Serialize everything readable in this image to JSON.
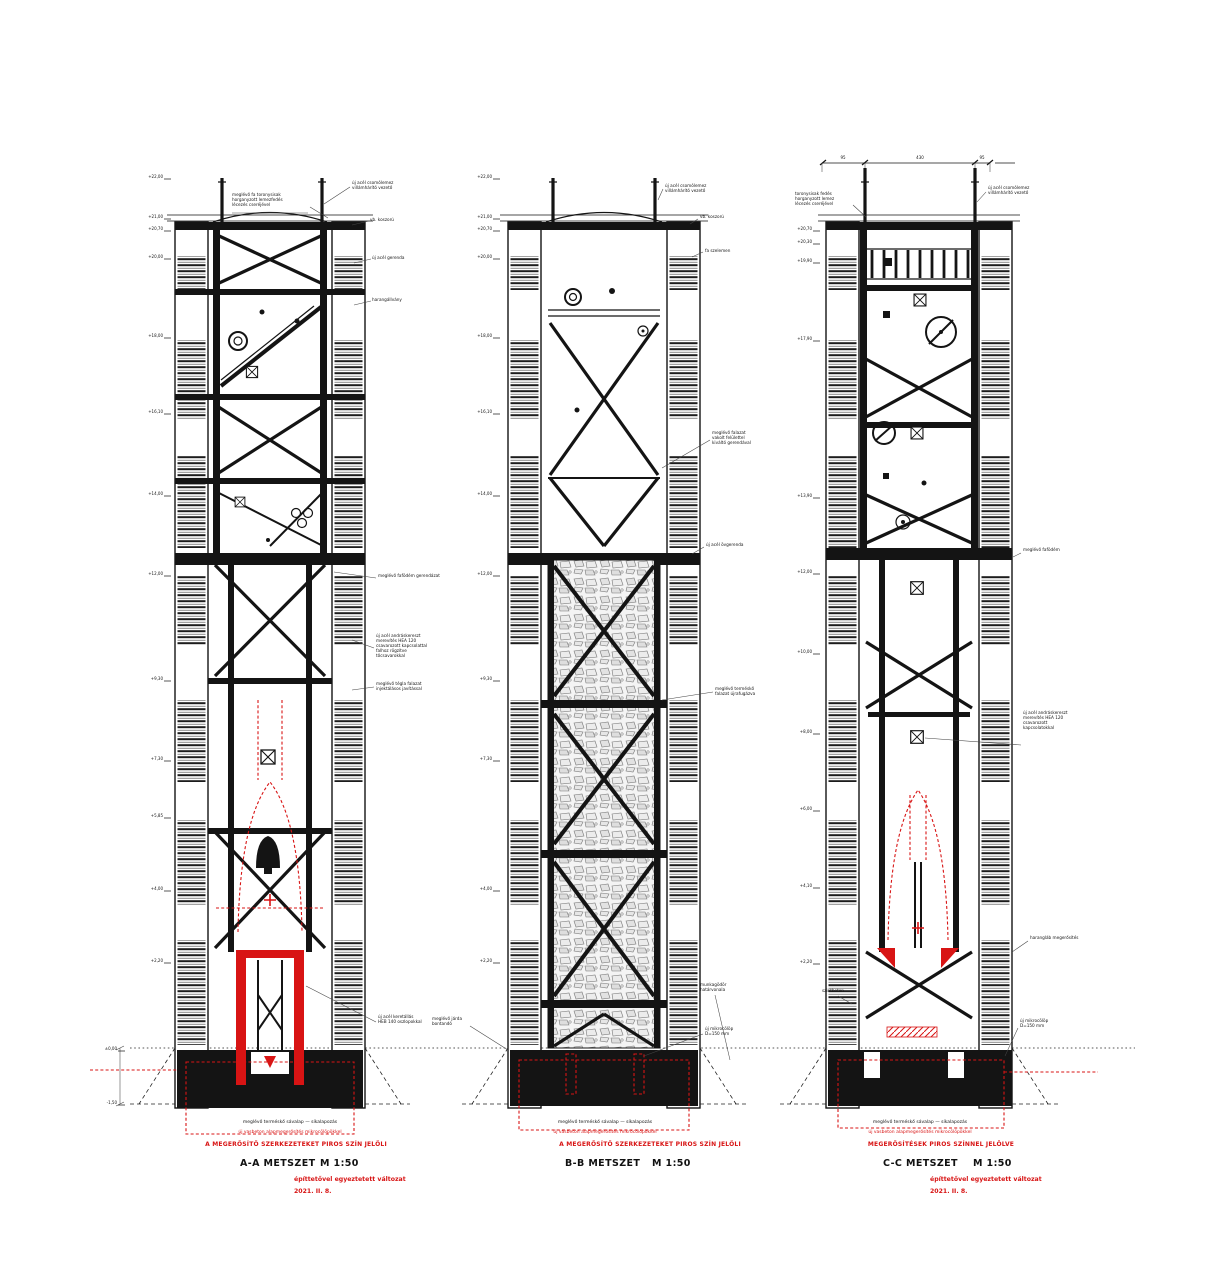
{
  "sheet": {
    "background": "#ffffff",
    "ink_color": "#141414",
    "accent_red": "#d81414",
    "scale_label": "M 1:50"
  },
  "towers": [
    {
      "id": "A",
      "title": "A-A METSZET",
      "scale": "M 1:50",
      "banner_red": "A MEGERŐSÍTŐ SZERKEZETEKET PIROS SZÍN JELÖLI",
      "foundation_note_black": "meglévő terméskő sávalap — síkalapozás",
      "foundation_note_red": "új vasbeton alapmegerősítés mikrocölöpökkel",
      "sub_red_1": "építtetővel egyeztetett változat",
      "sub_red_2": "2021. II. 8.",
      "annotations": [
        {
          "x": 352,
          "y": 184,
          "lines": [
            "új acél csomólemez",
            "villámhárító vezető"
          ]
        },
        {
          "x": 232,
          "y": 196,
          "lines": [
            "meglévő fa toronysisak",
            "horganyzott lemezfedés",
            "lécezés cseréjével"
          ]
        },
        {
          "x": 370,
          "y": 221,
          "lines": [
            "vb. koszorú"
          ]
        },
        {
          "x": 372,
          "y": 259,
          "lines": [
            "új acél gerenda"
          ]
        },
        {
          "x": 372,
          "y": 301,
          "lines": [
            "harangállvány"
          ]
        },
        {
          "x": 378,
          "y": 577,
          "lines": [
            "meglévő fafödém gerendázat"
          ]
        },
        {
          "x": 376,
          "y": 637,
          "lines": [
            "új acél andráskereszt",
            "merevítés HEA 120",
            "csavarozott kapcsolattal",
            "falhoz rögzítve",
            "tőcsavarokkal"
          ]
        },
        {
          "x": 376,
          "y": 685,
          "lines": [
            "meglévő tégla falazat",
            "injektálásos javítással"
          ]
        },
        {
          "x": 378,
          "y": 1018,
          "lines": [
            "új acél keretállás",
            "HEB 140 oszlopokkal"
          ]
        }
      ],
      "elevation_marks": [
        {
          "x": 163,
          "y": 178,
          "label": "+22,00"
        },
        {
          "x": 163,
          "y": 218,
          "label": "+21,00"
        },
        {
          "x": 163,
          "y": 230,
          "label": "+20,70"
        },
        {
          "x": 163,
          "y": 258,
          "label": "+20,00"
        },
        {
          "x": 163,
          "y": 337,
          "label": "+18,00"
        },
        {
          "x": 163,
          "y": 413,
          "label": "+16,10"
        },
        {
          "x": 163,
          "y": 495,
          "label": "+14,00"
        },
        {
          "x": 163,
          "y": 575,
          "label": "+12,00"
        },
        {
          "x": 163,
          "y": 680,
          "label": "+9,30"
        },
        {
          "x": 163,
          "y": 760,
          "label": "+7,30"
        },
        {
          "x": 163,
          "y": 817,
          "label": "+5,85"
        },
        {
          "x": 163,
          "y": 890,
          "label": "+4,00"
        },
        {
          "x": 163,
          "y": 962,
          "label": "+2,20"
        },
        {
          "x": 117,
          "y": 1050,
          "label": "±0,00"
        },
        {
          "x": 117,
          "y": 1104,
          "label": "-1,50"
        }
      ]
    },
    {
      "id": "B",
      "title": "B-B METSZET",
      "scale": "M 1:50",
      "banner_red": "A MEGERŐSÍTŐ SZERKEZETEKET PIROS SZÍN JELÖLI",
      "foundation_note_black": "meglévő terméskő sávalap — síkalapozás",
      "foundation_note_red": "új vasbeton alapmegerősítés mikrocölöpökkel",
      "annotations": [
        {
          "x": 665,
          "y": 187,
          "lines": [
            "új acél csomólemez",
            "villámhárító vezető"
          ]
        },
        {
          "x": 700,
          "y": 218,
          "lines": [
            "vb. koszorú"
          ]
        },
        {
          "x": 705,
          "y": 252,
          "lines": [
            "fa szelemen"
          ]
        },
        {
          "x": 712,
          "y": 434,
          "lines": [
            "meglévő falazat",
            "vakolt felülettel",
            "kiváltó gerendával"
          ]
        },
        {
          "x": 706,
          "y": 546,
          "lines": [
            "új acél övgerenda"
          ]
        },
        {
          "x": 715,
          "y": 690,
          "lines": [
            "meglévő terméskő",
            "falazat újrafugázva"
          ]
        },
        {
          "x": 700,
          "y": 986,
          "lines": [
            "munkagödör",
            "határvonala"
          ]
        },
        {
          "x": 705,
          "y": 1030,
          "lines": [
            "új mikrocölöp",
            "D=150 mm"
          ]
        },
        {
          "x": 432,
          "y": 1020,
          "lines": [
            "meglévő járda",
            "bontandó"
          ]
        }
      ],
      "elevation_marks": [
        {
          "x": 492,
          "y": 178,
          "label": "+22,00"
        },
        {
          "x": 492,
          "y": 218,
          "label": "+21,00"
        },
        {
          "x": 492,
          "y": 230,
          "label": "+20,70"
        },
        {
          "x": 492,
          "y": 258,
          "label": "+20,00"
        },
        {
          "x": 492,
          "y": 337,
          "label": "+18,00"
        },
        {
          "x": 492,
          "y": 413,
          "label": "+16,10"
        },
        {
          "x": 492,
          "y": 495,
          "label": "+14,00"
        },
        {
          "x": 492,
          "y": 575,
          "label": "+12,00"
        },
        {
          "x": 492,
          "y": 680,
          "label": "+9,30"
        },
        {
          "x": 492,
          "y": 760,
          "label": "+7,30"
        },
        {
          "x": 492,
          "y": 890,
          "label": "+4,00"
        },
        {
          "x": 492,
          "y": 962,
          "label": "+2,20"
        }
      ]
    },
    {
      "id": "C",
      "title": "C-C METSZET",
      "scale": "M 1:50",
      "banner_red": "MEGERŐSÍTÉSEK PIROS SZÍNNEL JELÖLVE",
      "foundation_note_black": "meglévő terméskő sávalap — síkalapozás",
      "foundation_note_red": "új vasbeton alapmegerősítés mikrocölöpökkel",
      "sub_red_1": "építtetővel egyeztetett változat",
      "sub_red_2": "2021. II. 8.",
      "annotations": [
        {
          "x": 795,
          "y": 195,
          "lines": [
            "toronysisak fedés",
            "horganyzott lemez",
            "lécezés cseréjével"
          ]
        },
        {
          "x": 988,
          "y": 189,
          "lines": [
            "új acél csomólemez",
            "villámhárító vezető"
          ]
        },
        {
          "x": 1023,
          "y": 551,
          "lines": [
            "meglévő fafödém"
          ]
        },
        {
          "x": 1023,
          "y": 714,
          "lines": [
            "új acél andráskereszt",
            "merevítés HEA 120",
            "csavarozott",
            "kapcsolatokkal"
          ]
        },
        {
          "x": 1030,
          "y": 939,
          "lines": [
            "harangláb megerősítés"
          ]
        },
        {
          "x": 1020,
          "y": 1022,
          "lines": [
            "új mikrocölöp",
            "D=150 mm"
          ]
        },
        {
          "x": 822,
          "y": 992,
          "lines": [
            "szintbeton"
          ]
        }
      ],
      "elevation_marks": [
        {
          "x": 812,
          "y": 230,
          "label": "+20,70"
        },
        {
          "x": 812,
          "y": 243,
          "label": "+20,30"
        },
        {
          "x": 812,
          "y": 262,
          "label": "+19,90"
        },
        {
          "x": 812,
          "y": 340,
          "label": "+17,90"
        },
        {
          "x": 812,
          "y": 497,
          "label": "+13,90"
        },
        {
          "x": 812,
          "y": 573,
          "label": "+12,00"
        },
        {
          "x": 812,
          "y": 653,
          "label": "+10,00"
        },
        {
          "x": 812,
          "y": 733,
          "label": "+8,00"
        },
        {
          "x": 812,
          "y": 810,
          "label": "+6,00"
        },
        {
          "x": 812,
          "y": 887,
          "label": "+4,10"
        },
        {
          "x": 812,
          "y": 963,
          "label": "+2,20"
        }
      ],
      "dimension_labels": [
        {
          "x": 843,
          "y": 159,
          "label": "95"
        },
        {
          "x": 920,
          "y": 159,
          "label": "430"
        },
        {
          "x": 982,
          "y": 159,
          "label": "95"
        }
      ]
    }
  ]
}
